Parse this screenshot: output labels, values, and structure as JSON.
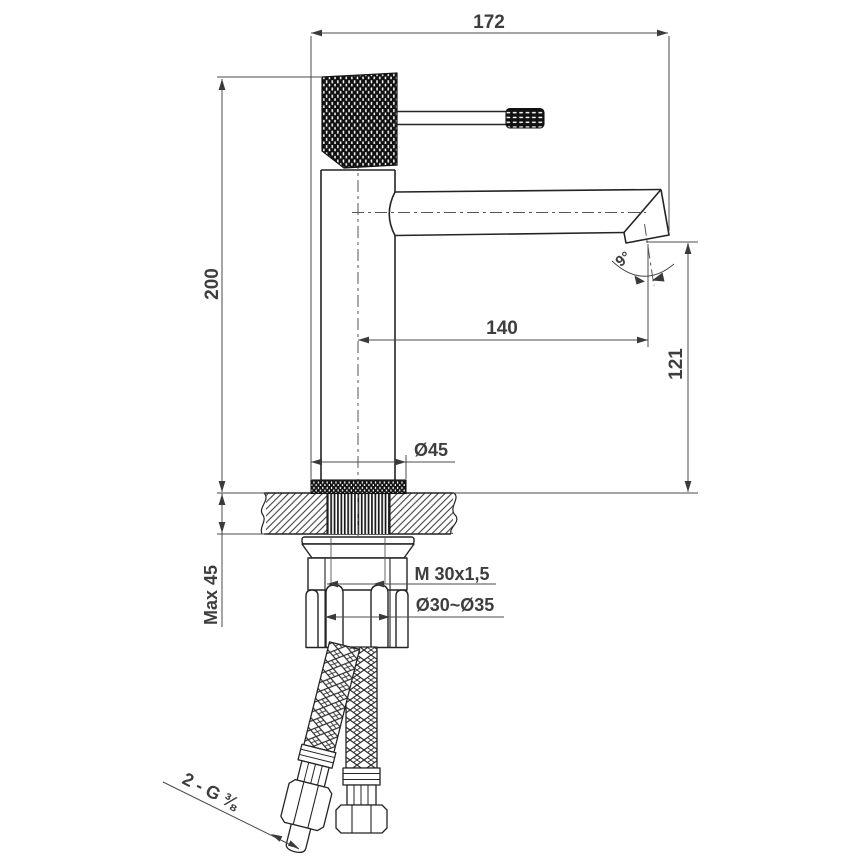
{
  "title": "Single-lever basin mixer tap - installation technical drawing",
  "dimensions": {
    "overall_width": "172",
    "total_height": "200",
    "spout_reach": "140",
    "spout_outlet_height": "121",
    "outlet_angle": "9°",
    "base_diameter": "Ø45",
    "max_counter_thickness": "Max 45",
    "fixing_thread": "M 30x1,5",
    "mounting_hole": "Ø30~Ø35",
    "hose_connections": "2 - G ⅜"
  }
}
